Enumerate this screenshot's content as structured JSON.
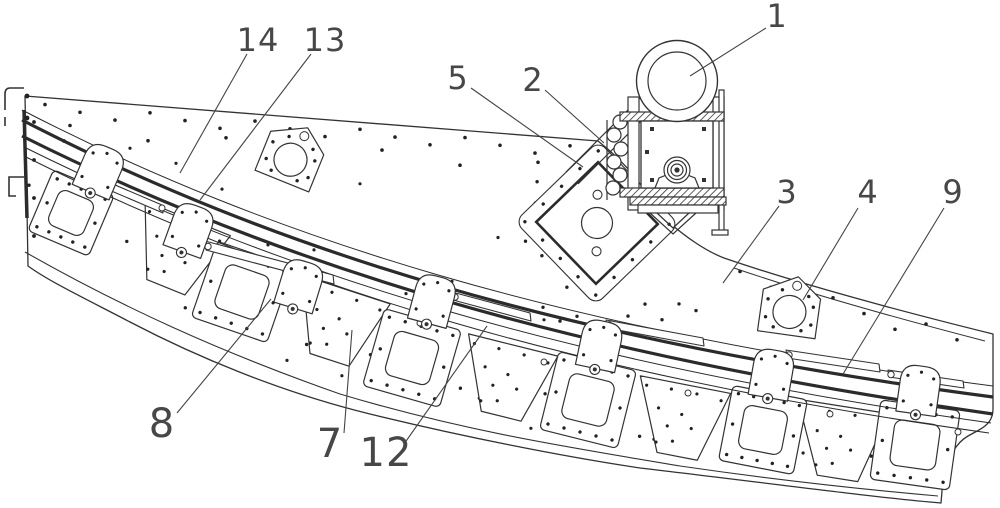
{
  "figure": {
    "type": "patent-mechanical-drawing",
    "background": "#ffffff",
    "ink": "#333333",
    "digit_color": "#474747",
    "callouts": [
      {
        "label": "1",
        "tx": 777,
        "ty": 16,
        "fs": 32,
        "x1": 766,
        "y1": 28,
        "x2": 690,
        "y2": 76
      },
      {
        "label": "2",
        "tx": 533,
        "ty": 80,
        "fs": 32,
        "x1": 545,
        "y1": 90,
        "x2": 604,
        "y2": 143
      },
      {
        "label": "5",
        "tx": 458,
        "ty": 78,
        "fs": 32,
        "x1": 471,
        "y1": 88,
        "x2": 583,
        "y2": 167
      },
      {
        "label": "13",
        "tx": 325,
        "ty": 40,
        "fs": 32,
        "x1": 311,
        "y1": 54,
        "x2": 200,
        "y2": 200
      },
      {
        "label": "14",
        "tx": 258,
        "ty": 40,
        "fs": 32,
        "x1": 247,
        "y1": 54,
        "x2": 180,
        "y2": 173
      },
      {
        "label": "3",
        "tx": 787,
        "ty": 192,
        "fs": 32,
        "x1": 779,
        "y1": 206,
        "x2": 723,
        "y2": 283
      },
      {
        "label": "4",
        "tx": 868,
        "ty": 192,
        "fs": 32,
        "x1": 858,
        "y1": 208,
        "x2": 803,
        "y2": 300
      },
      {
        "label": "9",
        "tx": 953,
        "ty": 192,
        "fs": 32,
        "x1": 944,
        "y1": 208,
        "x2": 843,
        "y2": 374
      },
      {
        "label": "8",
        "tx": 162,
        "ty": 424,
        "fs": 40,
        "x1": 177,
        "y1": 413,
        "x2": 271,
        "y2": 299
      },
      {
        "label": "7",
        "tx": 330,
        "ty": 444,
        "fs": 40,
        "x1": 344,
        "y1": 433,
        "x2": 352,
        "y2": 330
      },
      {
        "label": "12",
        "tx": 386,
        "ty": 453,
        "fs": 40,
        "x1": 404,
        "y1": 444,
        "x2": 487,
        "y2": 326
      }
    ],
    "components": {
      "plates": [
        {
          "cx": 71,
          "cy": 213,
          "rot": 23,
          "s": 33
        },
        {
          "cx": 242,
          "cy": 292,
          "rot": 19,
          "s": 40
        },
        {
          "cx": 412,
          "cy": 358,
          "rot": 16,
          "s": 40
        },
        {
          "cx": 588,
          "cy": 400,
          "rot": 14,
          "s": 40
        },
        {
          "cx": 763,
          "cy": 430,
          "rot": 11,
          "s": 38
        },
        {
          "cx": 915,
          "cy": 445,
          "rot": 8,
          "s": 40
        }
      ],
      "gussets": [
        {
          "cx": 175,
          "cy": 250,
          "rot": 22
        },
        {
          "cx": 336,
          "cy": 322,
          "rot": 18
        },
        {
          "cx": 505,
          "cy": 378,
          "rot": 14
        },
        {
          "cx": 679,
          "cy": 418,
          "rot": 11
        },
        {
          "cx": 838,
          "cy": 440,
          "rot": 9
        }
      ],
      "tabs": [
        {
          "cx": 100,
          "cy": 170,
          "rot": 23
        },
        {
          "cx": 190,
          "cy": 229,
          "rot": 20
        },
        {
          "cx": 300,
          "cy": 285,
          "rot": 17
        },
        {
          "cx": 433,
          "cy": 300,
          "rot": 15
        },
        {
          "cx": 600,
          "cy": 345,
          "rot": 12
        },
        {
          "cx": 772,
          "cy": 374,
          "rot": 10
        },
        {
          "cx": 919,
          "cy": 390,
          "rot": 8
        }
      ],
      "hole_brackets": [
        {
          "cx": 292,
          "cy": 156,
          "rot": 22
        },
        {
          "cx": 790,
          "cy": 308,
          "rot": 8
        }
      ],
      "diamond": {
        "cx": 597,
        "cy": 223,
        "rot": 46
      },
      "slats": [
        [
          80,
          170,
          162,
          205,
          8
        ],
        [
          205,
          241,
          333,
          275,
          9
        ],
        [
          452,
          292,
          530,
          313,
          8
        ],
        [
          606,
          320,
          703,
          338,
          8
        ],
        [
          786,
          350,
          879,
          364,
          8
        ],
        [
          888,
          370,
          963,
          381,
          7
        ]
      ],
      "rail_bolts": [
        [
          98,
          172
        ],
        [
          162,
          208
        ],
        [
          290,
          272
        ],
        [
          420,
          323
        ],
        [
          544,
          362
        ],
        [
          688,
          393
        ],
        [
          830,
          414
        ],
        [
          958,
          432
        ]
      ]
    }
  }
}
